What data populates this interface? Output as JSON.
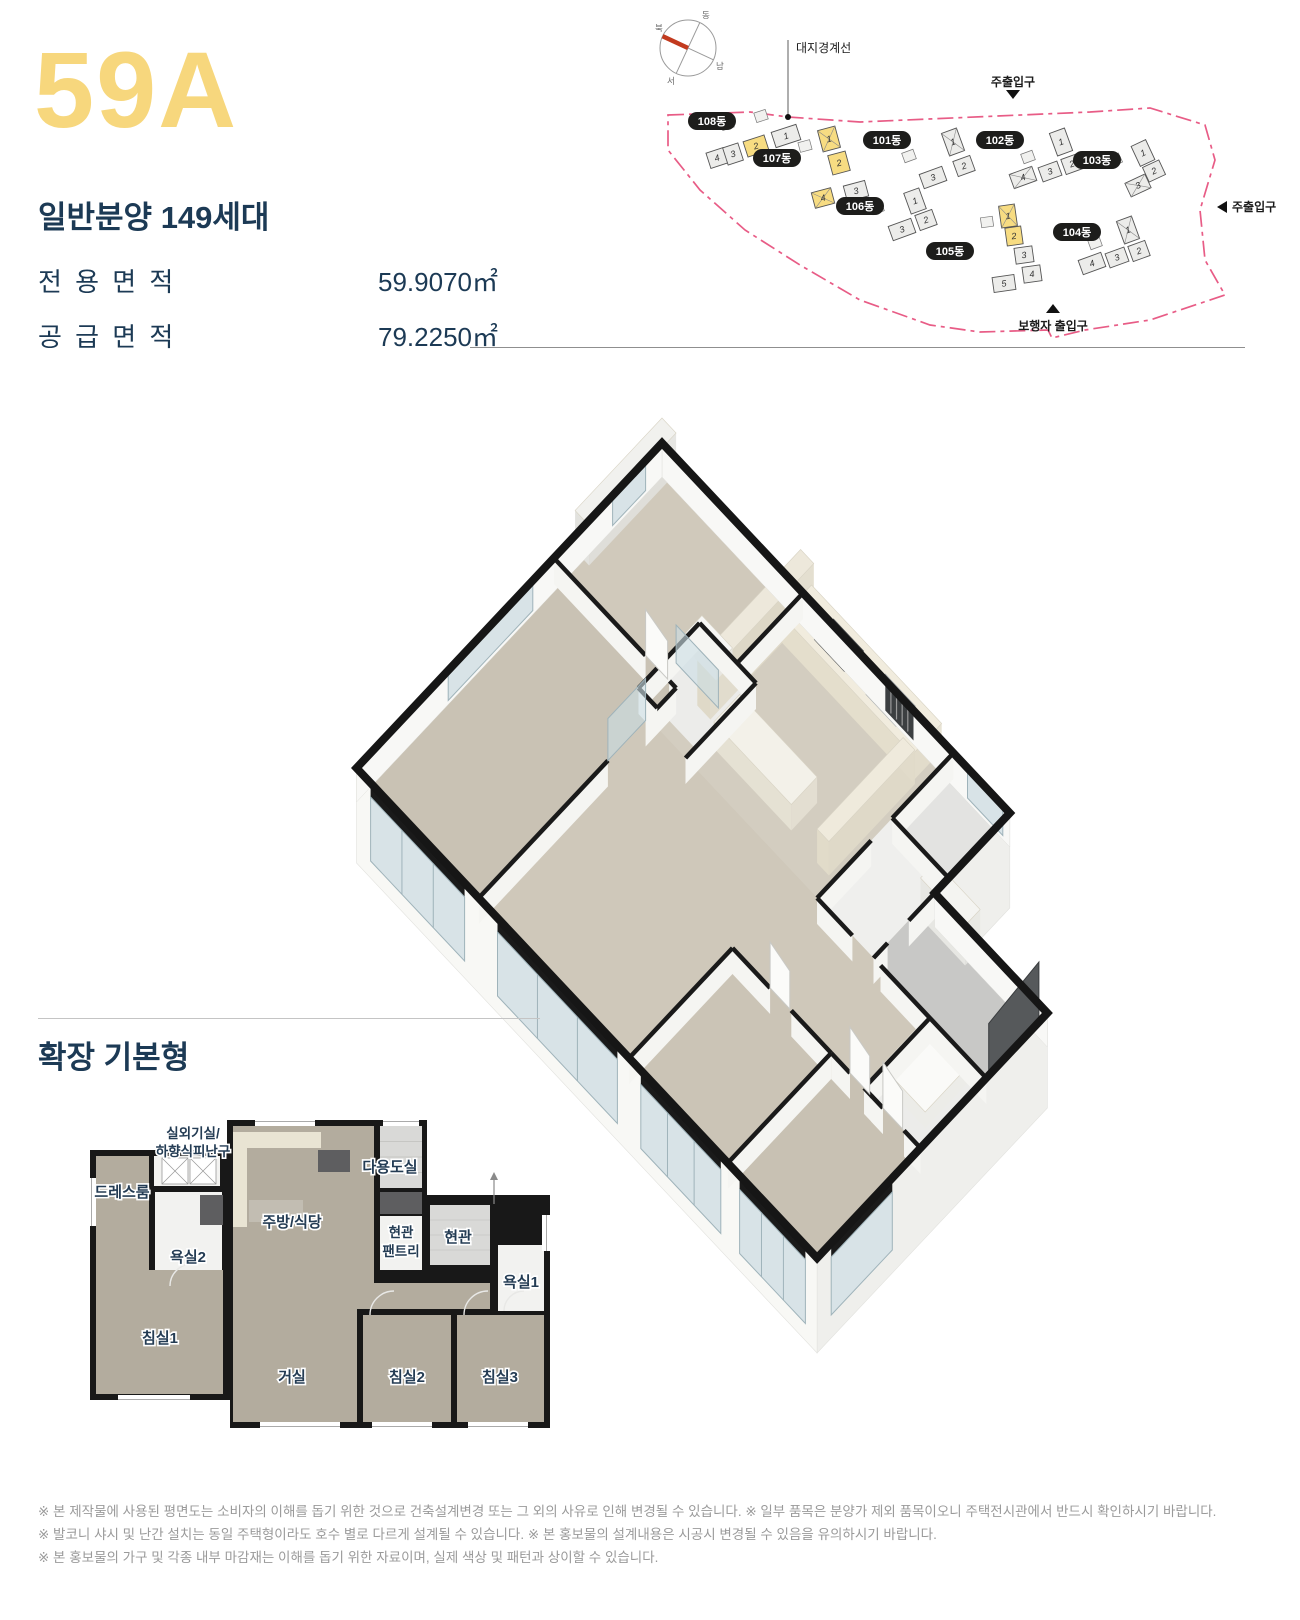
{
  "header": {
    "type_code": "59A",
    "type_code_color": "#F7D77D",
    "navy_color": "#1C3A55",
    "sale_info": "일반분양 149세대",
    "area_rows": [
      {
        "label": "전 용 면 적",
        "value": "59.9070㎡"
      },
      {
        "label": "공 급 면 적",
        "value": "79.2250㎡"
      }
    ]
  },
  "site_plan": {
    "boundary_color": "#E85C86",
    "compass_needle_color": "#C23A1E",
    "building_fill": "#ECECEA",
    "highlight_color": "#F7DC82",
    "label_pill_color": "#1D1D1B",
    "labels": {
      "site_boundary": "대지경계선",
      "main_entrance_top": "주출입구",
      "main_entrance_right": "주출입구",
      "pedestrian_entrance": "보행자 출입구"
    },
    "compass_points": [
      "북",
      "동",
      "남",
      "서"
    ],
    "buildings": [
      {
        "name": "108동",
        "units": [
          {
            "no": "4"
          },
          {
            "no": "3"
          },
          {
            "no": "2",
            "highlight": true
          },
          {
            "no": "1"
          }
        ]
      },
      {
        "name": "107동",
        "units": [
          {
            "no": "1",
            "highlight": true
          },
          {
            "no": "2",
            "highlight": true
          },
          {
            "no": "3"
          },
          {
            "no": "4",
            "highlight": true
          }
        ]
      },
      {
        "name": "101동",
        "units": [
          {
            "no": "1"
          },
          {
            "no": "2"
          },
          {
            "no": "3"
          }
        ]
      },
      {
        "name": "102동",
        "units": [
          {
            "no": "1"
          },
          {
            "no": "2"
          },
          {
            "no": "3"
          },
          {
            "no": "4"
          }
        ]
      },
      {
        "name": "103동",
        "units": [
          {
            "no": "1"
          },
          {
            "no": "2"
          },
          {
            "no": "3"
          }
        ]
      },
      {
        "name": "106동",
        "units": [
          {
            "no": "1"
          },
          {
            "no": "2"
          },
          {
            "no": "3"
          }
        ]
      },
      {
        "name": "105동",
        "units": [
          {
            "no": "1",
            "highlight": true
          },
          {
            "no": "2",
            "highlight": true
          },
          {
            "no": "3"
          },
          {
            "no": "4"
          },
          {
            "no": "5"
          }
        ]
      },
      {
        "name": "104동",
        "units": [
          {
            "no": "1"
          },
          {
            "no": "2"
          },
          {
            "no": "3"
          },
          {
            "no": "4"
          }
        ]
      }
    ]
  },
  "floor_plan_2d": {
    "section_title": "확장 기본형",
    "rooms": [
      {
        "label": "실외기실/",
        "label2": "하향식피난구"
      },
      {
        "label": "드레스룸"
      },
      {
        "label": "욕실2"
      },
      {
        "label": "주방/식당"
      },
      {
        "label": "다용도실"
      },
      {
        "label": "현관",
        "label2": "팬트리"
      },
      {
        "label": "현관"
      },
      {
        "label": "욕실1"
      },
      {
        "label": "침실1"
      },
      {
        "label": "거실"
      },
      {
        "label": "침실2"
      },
      {
        "label": "침실3"
      }
    ]
  },
  "disclaimers": [
    "※ 본 제작물에 사용된 평면도는 소비자의 이해를 돕기 위한 것으로 건축설계변경 또는 그 외의 사유로 인해 변경될 수 있습니다. ※ 일부 품목은 분양가 제외 품목이오니 주택전시관에서 반드시 확인하시기 바랍니다.",
    "※ 발코니 샤시 및 난간 설치는 동일 주택형이라도 호수 별로 다르게 설계될 수 있습니다. ※ 본 홍보물의 설계내용은 시공시 변경될 수 있음을 유의하시기 바랍니다.",
    "※ 본 홍보물의 가구 및 각종 내부 마감재는 이해를 돕기 위한 자료이며, 실제 색상 및 패턴과 상이할 수 있습니다."
  ]
}
